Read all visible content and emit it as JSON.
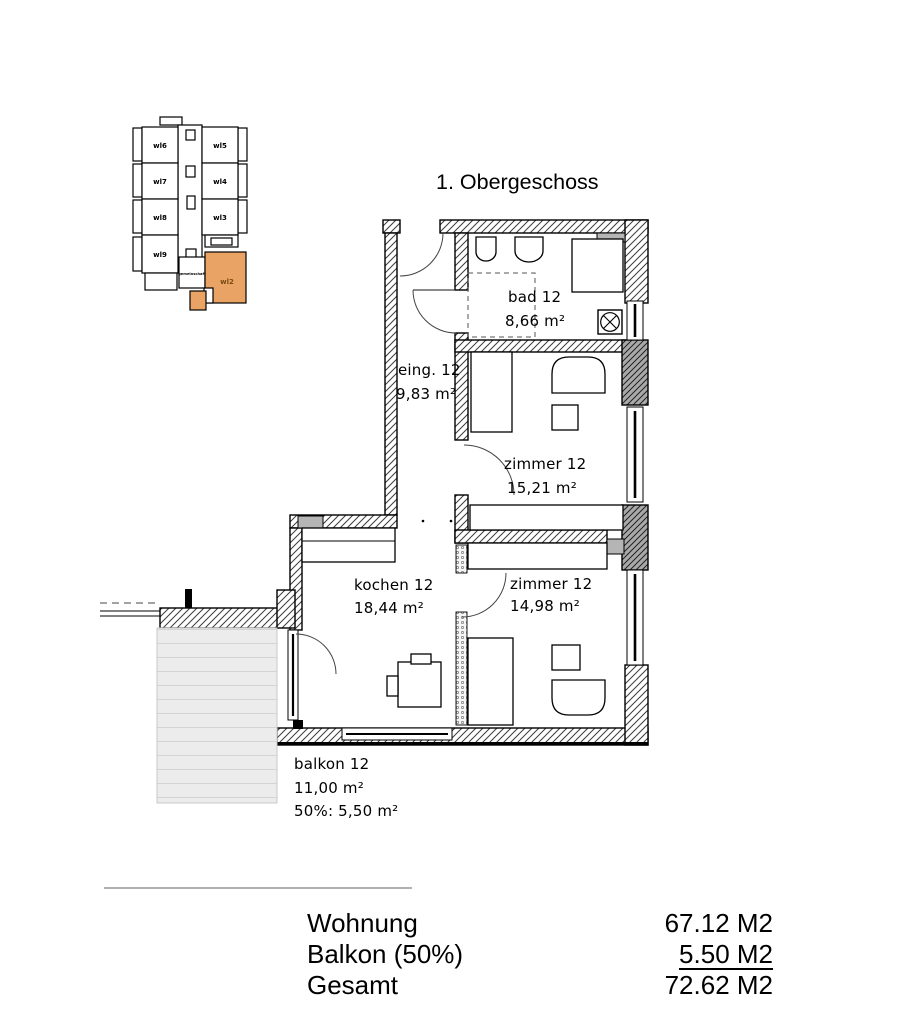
{
  "title": "1. Obergeschoss",
  "key_plan": {
    "highlight_color": "#e9a465",
    "highlighted_unit": "wl2",
    "units": [
      {
        "label": "wl6"
      },
      {
        "label": "wl7"
      },
      {
        "label": "wl8"
      },
      {
        "label": "wl9"
      },
      {
        "label": "wl5"
      },
      {
        "label": "wl4"
      },
      {
        "label": "wl3"
      },
      {
        "label": "gemeinschaft"
      },
      {
        "label": "wl2"
      }
    ]
  },
  "rooms": [
    {
      "name": "bad 12",
      "area": "8,66 m²"
    },
    {
      "name": "eing. 12",
      "area": "9,83 m²"
    },
    {
      "name": "zimmer 12",
      "area": "15,21 m²"
    },
    {
      "name": "kochen 12",
      "area": "18,44 m²"
    },
    {
      "name": "zimmer 12",
      "area": "14,98 m²"
    },
    {
      "name": "balkon 12",
      "area": "11,00 m²",
      "area_half": "50%: 5,50 m²"
    }
  ],
  "summary": {
    "rows": [
      {
        "label": "Wohnung",
        "value": "67.12 M2"
      },
      {
        "label": "Balkon (50%)",
        "value": "5.50 M2"
      },
      {
        "label": "Gesamt",
        "value": "72.62 M2"
      }
    ]
  }
}
